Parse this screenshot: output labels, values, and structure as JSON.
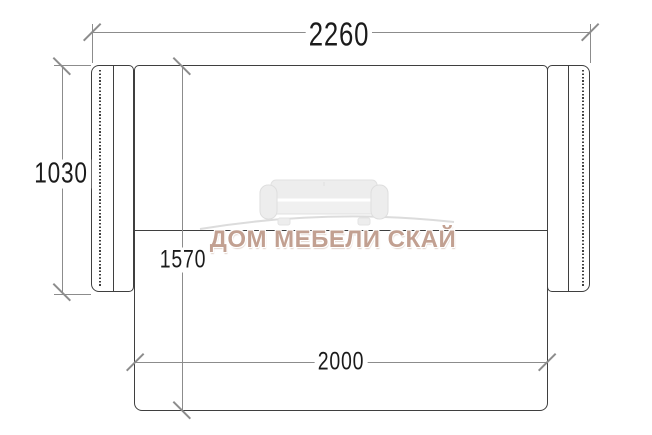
{
  "diagram": {
    "type": "furniture-dimension-drawing",
    "subject": "sofa-bed-top-view",
    "dimensions": {
      "top": {
        "label": "2260",
        "orientation": "horizontal",
        "position": "top"
      },
      "left": {
        "label": "1030",
        "orientation": "vertical",
        "position": "left"
      },
      "middle": {
        "label": "1570",
        "orientation": "vertical",
        "position": "center"
      },
      "bottom": {
        "label": "2000",
        "orientation": "horizontal",
        "position": "bottom"
      }
    },
    "colors": {
      "background": "#ffffff",
      "furniture_outline": "#3f3f3f",
      "dimension_lines": "#8c8c8c",
      "dimension_text": "#1b1b1b"
    }
  },
  "watermark": {
    "text": "ДОМ МЕБЕЛИ СКАЙ",
    "text_color": "#c2a091",
    "logo": "sofa-icon",
    "logo_color": "#ededed"
  }
}
